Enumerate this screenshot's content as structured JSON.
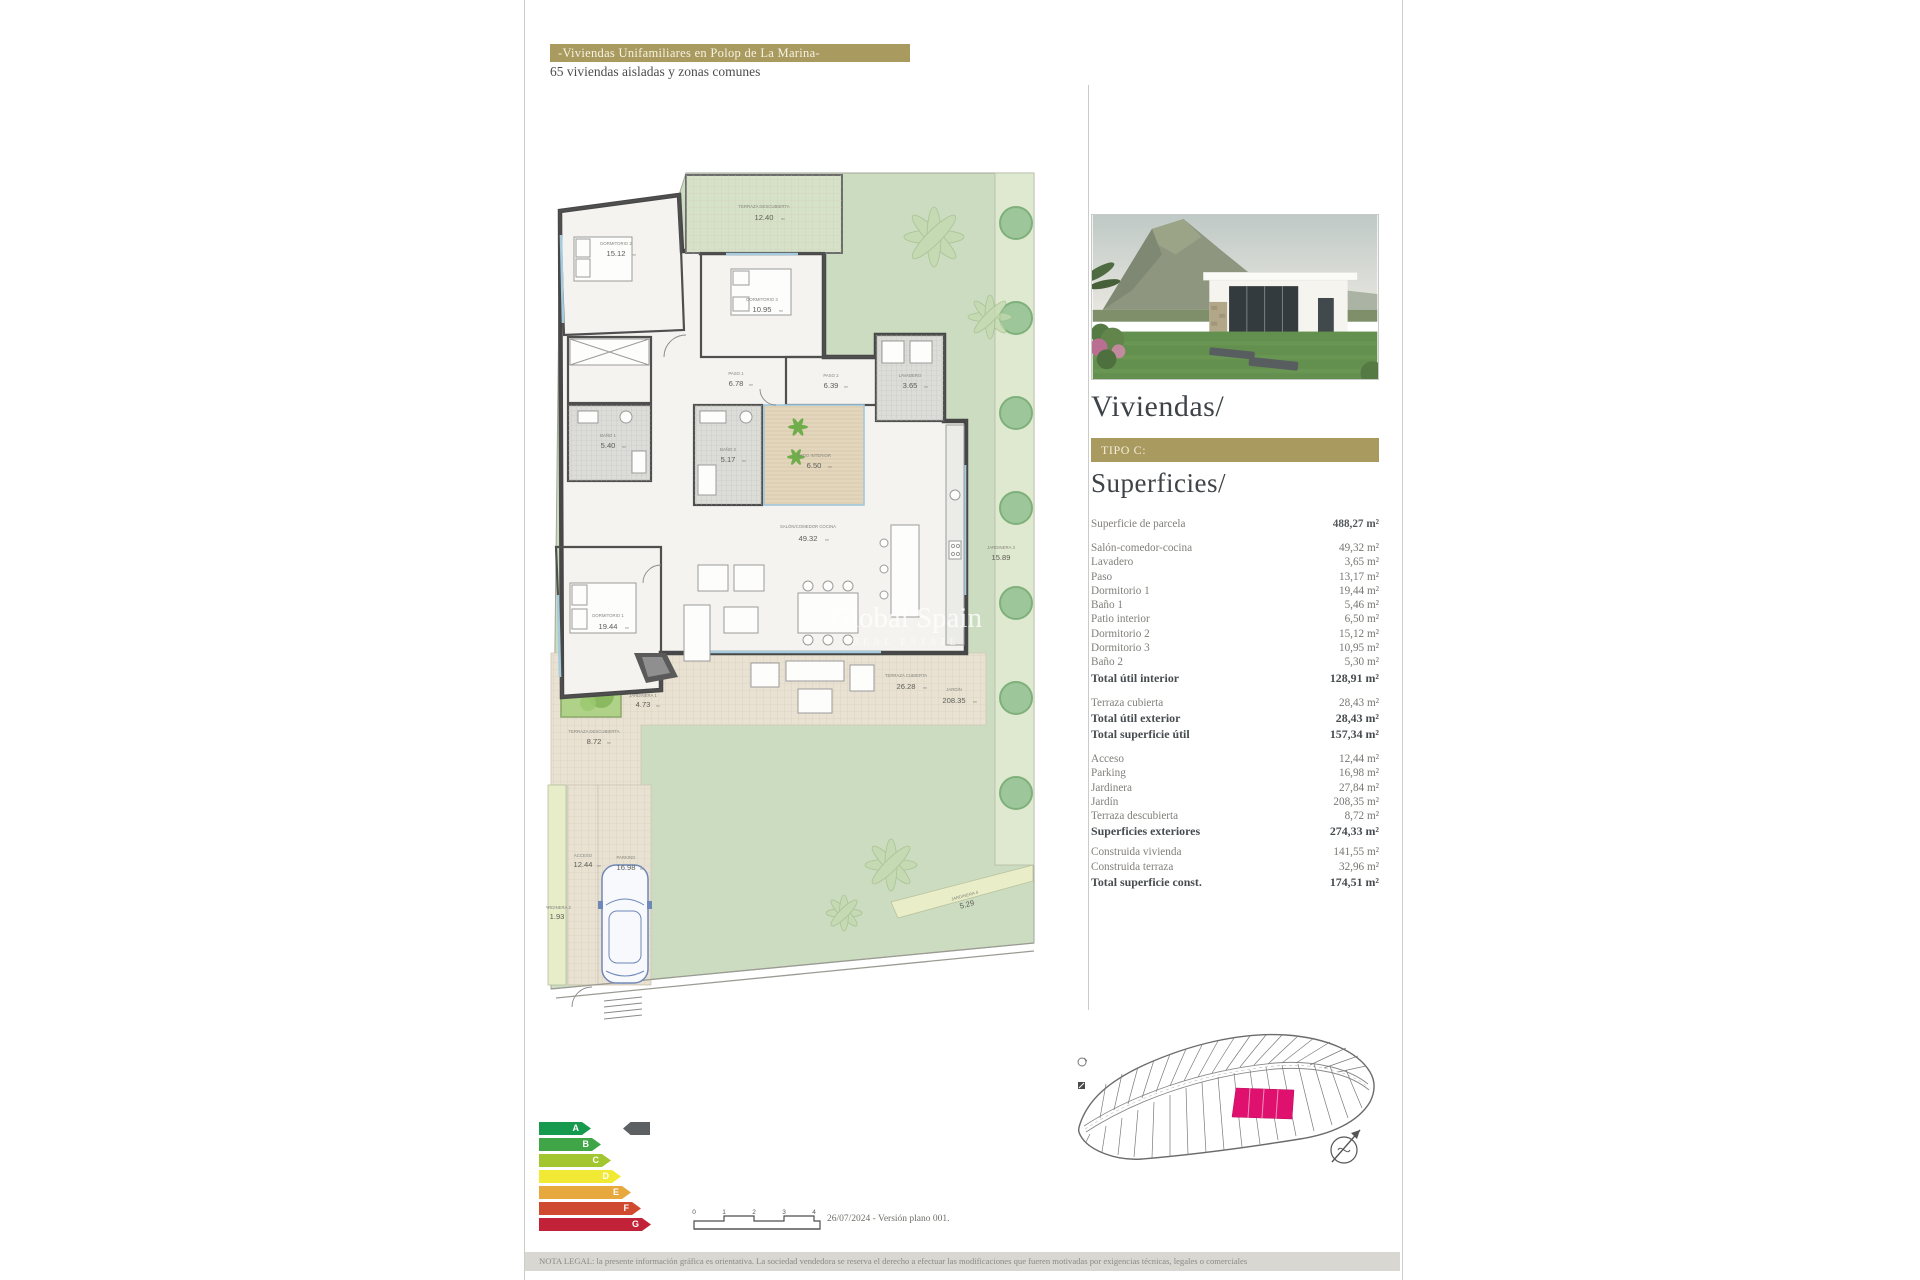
{
  "header": {
    "title": "-Viviendas Unifamiliares en Polop de La Marina-",
    "subtitle": "65 viviendas aisladas y zonas comunes"
  },
  "watermark": {
    "line1": "Global Spain",
    "line2": "REAL ESTATE"
  },
  "plan": {
    "area_unit": "m²",
    "rooms": {
      "dormitorio2": {
        "name": "DORMITORIO 2",
        "area": "15.12"
      },
      "terraza_sup": {
        "name": "TERRAZA DESCUBIERTA",
        "area": "12.40"
      },
      "dormitorio3": {
        "name": "DORMITORIO 3",
        "area": "10.95"
      },
      "paso1": {
        "name": "PASO 1",
        "area": "6.78"
      },
      "bano1": {
        "name": "BAÑO 1",
        "area": "5.40"
      },
      "bano2": {
        "name": "BAÑO 2",
        "area": "5.17"
      },
      "paso2": {
        "name": "PASO 2",
        "area": "6.39"
      },
      "lavadero": {
        "name": "LAVADERO",
        "area": "3.65"
      },
      "patio": {
        "name": "PATIO INTERIOR",
        "area": "6.50"
      },
      "salon": {
        "name": "SALÓN/COMEDOR COCINA",
        "area": "49.32"
      },
      "dormitorio1": {
        "name": "DORMITORIO 1",
        "area": "19.44"
      },
      "jardinera1": {
        "name": "JARDINERA 1",
        "area": "4.73"
      },
      "terraza_desc": {
        "name": "TERRAZA DESCUBIERTA",
        "area": "8.72"
      },
      "terraza_cub": {
        "name": "TERRAZA CUBIERTA",
        "area": "26.28"
      },
      "jardin": {
        "name": "JARDÍN",
        "area": "208.35"
      },
      "acceso": {
        "name": "ACCESO",
        "area": "12.44"
      },
      "parking": {
        "name": "PARKING",
        "area": "16.98"
      },
      "jardinera2": {
        "name": "JARDINERA 2",
        "area": "1.93"
      },
      "jardinera3": {
        "name": "JARDINERA 3",
        "area": "15.89"
      },
      "jardinera4": {
        "name": "JARDINERA 4",
        "area": "5.29"
      }
    }
  },
  "sidebar": {
    "heading": "Viviendas/",
    "type_label": "TIPO C:",
    "subheading": "Superficies/",
    "rows": {
      "parcela": {
        "label": "Superficie de parcela",
        "value": "488,27 m²"
      },
      "salon": {
        "label": "Salón-comedor-cocina",
        "value": "49,32 m²"
      },
      "lavadero": {
        "label": "Lavadero",
        "value": "3,65 m²"
      },
      "paso": {
        "label": "Paso",
        "value": "13,17 m²"
      },
      "dormitorio1": {
        "label": "Dormitorio 1",
        "value": "19,44 m²"
      },
      "bano1": {
        "label": "Baño 1",
        "value": "5,46 m²"
      },
      "patio": {
        "label": "Patio interior",
        "value": "6,50 m²"
      },
      "dormitorio2": {
        "label": "Dormitorio 2",
        "value": "15,12 m²"
      },
      "dormitorio3": {
        "label": "Dormitorio 3",
        "value": "10,95 m²"
      },
      "bano2": {
        "label": "Baño 2",
        "value": "5,30 m²"
      },
      "total_interior": {
        "label": "Total útil interior",
        "value": "128,91 m²"
      },
      "terraza_cubierta": {
        "label": "Terraza cubierta",
        "value": "28,43 m²"
      },
      "total_exterior": {
        "label": "Total útil exterior",
        "value": "28,43 m²"
      },
      "total_util": {
        "label": "Total superficie útil",
        "value": "157,34 m²"
      },
      "acceso": {
        "label": "Acceso",
        "value": "12,44 m²"
      },
      "parking": {
        "label": "Parking",
        "value": "16,98 m²"
      },
      "jardinera": {
        "label": "Jardinera",
        "value": "27,84 m²"
      },
      "jardin": {
        "label": "Jardín",
        "value": "208,35 m²"
      },
      "terraza_descubierta": {
        "label": "Terraza descubierta",
        "value": "8,72 m²"
      },
      "sup_exteriores": {
        "label": "Superficies exteriores",
        "value": "274,33 m²"
      },
      "construida_vivienda": {
        "label": "Construida vivienda",
        "value": "141,55 m²"
      },
      "construida_terraza": {
        "label": "Construida terraza",
        "value": "32,96 m²"
      },
      "total_construida": {
        "label": "Total superficie const.",
        "value": "174,51 m²"
      }
    }
  },
  "energy": {
    "levels": [
      {
        "letter": "A",
        "color": "#179a4e"
      },
      {
        "letter": "B",
        "color": "#3fa547"
      },
      {
        "letter": "C",
        "color": "#a2c62f"
      },
      {
        "letter": "D",
        "color": "#f1e933"
      },
      {
        "letter": "E",
        "color": "#e7a83e"
      },
      {
        "letter": "F",
        "color": "#cf4a2f"
      },
      {
        "letter": "G",
        "color": "#c12237"
      }
    ],
    "pointer_color": "#5c6063"
  },
  "scalebar": {
    "ticks": [
      "0",
      "1",
      "2",
      "3",
      "4"
    ],
    "note": "26/07/2024 - Versión plano 001."
  },
  "legal": {
    "text": "NOTA LEGAL: la presente información gráfica es orientativa. La sociedad vendedora se reserva el derecho a efectuar las modificaciones que fueren motivadas por exigencias técnicas, legales o comerciales"
  },
  "colors": {
    "accent_gold": "#a99a60",
    "highlight_magenta": "#e0106f"
  }
}
